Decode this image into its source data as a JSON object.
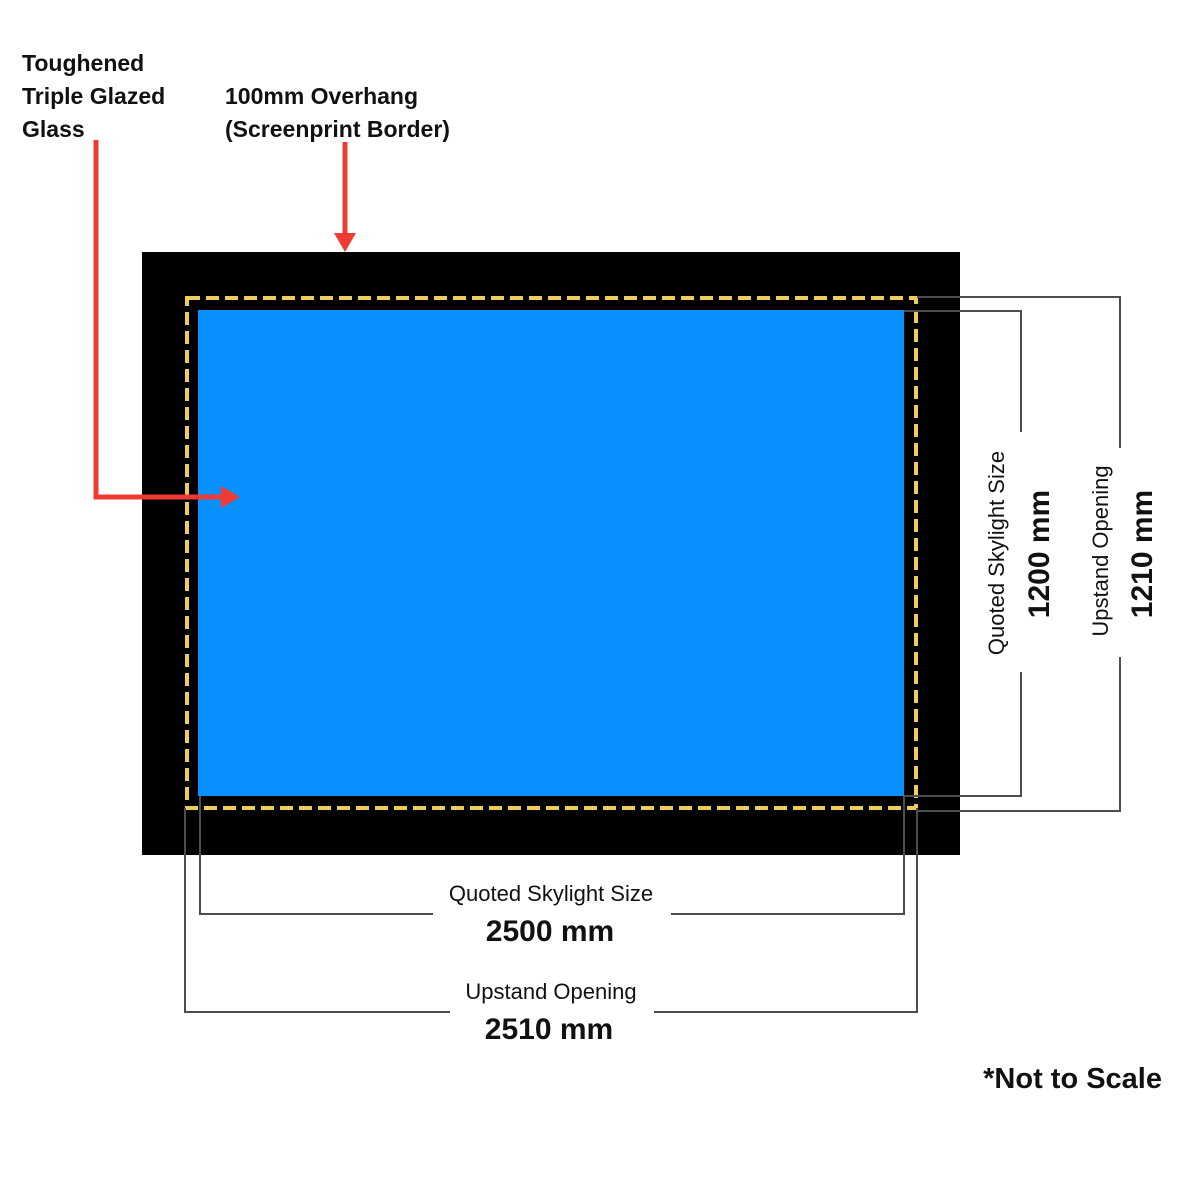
{
  "colors": {
    "frame": "#000000",
    "glass": "#0890FF",
    "screenprint_border": "#EFCD5C",
    "arrow": "#EF3B33",
    "dim_line": "#4D4D4D",
    "text": "#111111"
  },
  "annotations": {
    "glass_label": {
      "lines": [
        "Toughened",
        "Triple Glazed",
        "Glass"
      ]
    },
    "overhang_label": {
      "lines": [
        "100mm Overhang",
        "(Screenprint Border)"
      ]
    }
  },
  "dimensions": {
    "skylight_height": {
      "label": "Quoted Skylight Size",
      "value": "1200 mm"
    },
    "upstand_height": {
      "label": "Upstand Opening",
      "value": "1210 mm"
    },
    "skylight_width": {
      "label": "Quoted Skylight Size",
      "value": "2500 mm"
    },
    "upstand_width": {
      "label": "Upstand Opening",
      "value": "2510 mm"
    }
  },
  "footnote": "*Not to Scale"
}
